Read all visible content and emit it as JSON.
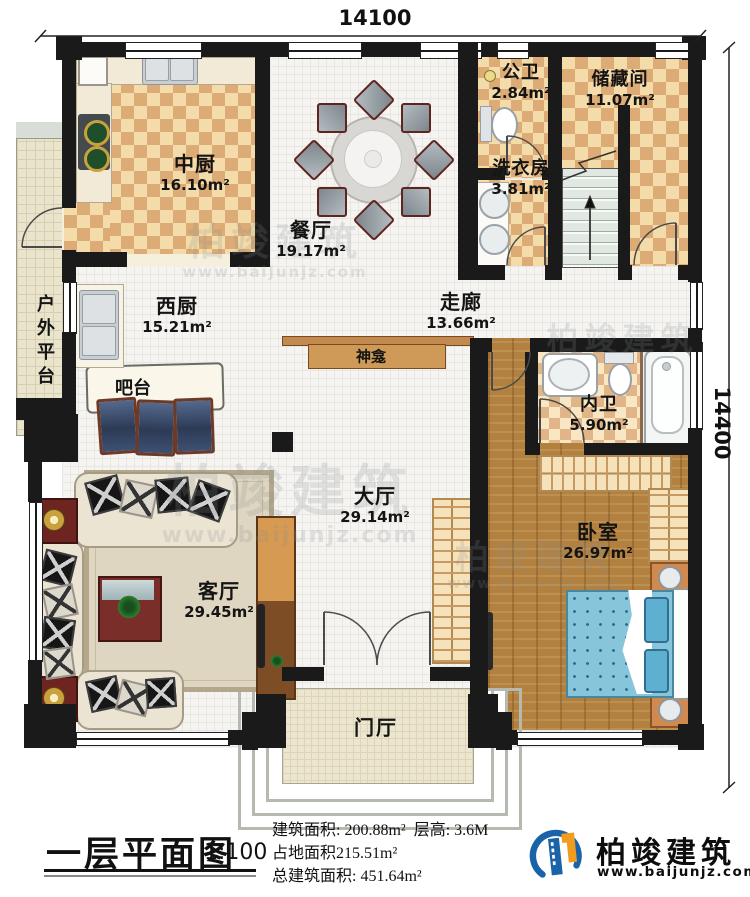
{
  "dims": {
    "top": "14100",
    "right": "14400"
  },
  "rooms": {
    "zhongchu": {
      "name": "中厨",
      "area": "16.10m²"
    },
    "canting": {
      "name": "餐厅",
      "area": "19.17m²"
    },
    "gongwei": {
      "name": "公卫",
      "area": "2.84m²"
    },
    "chucang": {
      "name": "储藏间",
      "area": "11.07m²"
    },
    "xiyi": {
      "name": "洗衣房",
      "area": "3.81m²"
    },
    "xichu": {
      "name": "西厨",
      "area": "15.21m²"
    },
    "zoulang": {
      "name": "走廊",
      "area": "13.66m²"
    },
    "neiwei": {
      "name": "内卫",
      "area": "5.90m²"
    },
    "dating": {
      "name": "大厅",
      "area": "29.14m²"
    },
    "woshi": {
      "name": "卧室",
      "area": "26.97m²"
    },
    "keting": {
      "name": "客厅",
      "area": "29.45m²"
    }
  },
  "features": {
    "outdoor": "户外平台",
    "bar": "吧台",
    "shrine": "神龛",
    "foyer": "门厅"
  },
  "footer": {
    "title": "一层平面图",
    "scale": "1:100",
    "stat1": "建筑面积: 200.88m²",
    "stat1b": "层高: 3.6M",
    "stat2": "占地面积215.51m²",
    "stat3": "总建筑面积: 451.64m²",
    "brand": "柏竣建筑",
    "url": "www.baijunjz.com"
  },
  "watermark": {
    "brand": "柏竣建筑",
    "url": "www.baijunjz.com"
  }
}
